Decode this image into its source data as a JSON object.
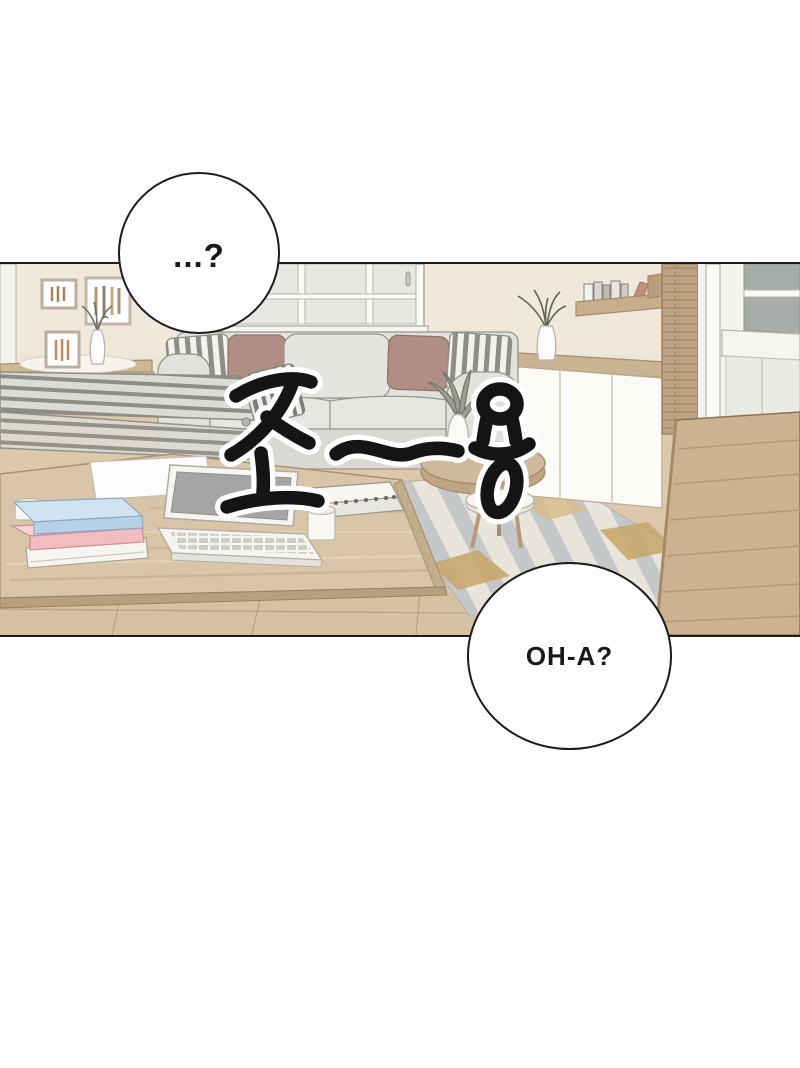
{
  "page": {
    "kind": "webtoon-comic-panel",
    "background": "#ffffff",
    "panel_border_color": "#1c1c1c"
  },
  "speech_bubbles": [
    {
      "id": "top-left",
      "text": "...?"
    },
    {
      "id": "bottom-right",
      "text": "OH-A?"
    }
  ],
  "sfx": {
    "text": "조~용",
    "fill": "#141414",
    "outline": "#ffffff"
  },
  "palette": {
    "wall": "#ece5d8",
    "sofa": "#e2e1db",
    "pillow_mauve": "#b18e83",
    "pillow_stripe": "#8f8f88",
    "wood_light": "#d9c6a8",
    "wood_mid": "#cdb292",
    "wood_column": "#bfa284",
    "floor": "#dcc9ab",
    "rug_gray": "#c4c8c9",
    "rug_cream": "#e9e5da",
    "rug_tan": "#c9a76e",
    "glass": "#a9adaa",
    "book_blue": "#b7d2e7",
    "book_pink": "#f2bcc0",
    "laptop_screen": "#a5a5a3"
  },
  "scene": {
    "objects": [
      "wall",
      "window",
      "picture-frames",
      "flower-vase",
      "drawer-cabinet",
      "drying-rack",
      "sofa",
      "cushions",
      "wall-shelf-books",
      "sideboard",
      "plant-vase",
      "round-side-table",
      "white-stool",
      "area-rug",
      "wood-floor",
      "coffee-table",
      "book-stack",
      "laptop",
      "mug",
      "cup",
      "spiral-notebooks",
      "wood-partition",
      "glass-cabinet"
    ]
  }
}
